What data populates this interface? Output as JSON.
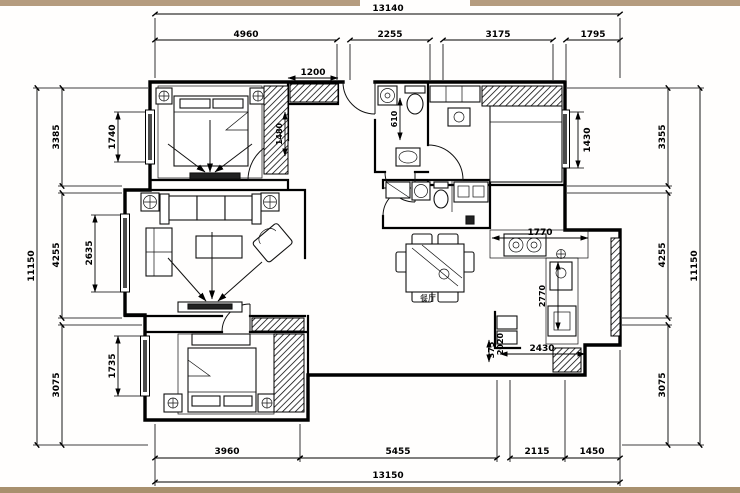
{
  "colors": {
    "edge_strip": "#b59c7f",
    "edge_strip_bottom": "#a8906e",
    "ink": "#000000",
    "paper": "#ffffff"
  },
  "dims": {
    "top": {
      "overall": "13140",
      "segments": [
        "4960",
        "2255",
        "3175",
        "1795"
      ]
    },
    "bottom": {
      "overall": "13150",
      "segments": [
        "3960",
        "5455",
        "2115",
        "1450"
      ]
    },
    "left": {
      "overall": "11150",
      "segments": [
        "3385",
        "4255",
        "3075"
      ],
      "inner": [
        "1740",
        "2635",
        "1735"
      ]
    },
    "right": {
      "overall": "11150",
      "segments": [
        "3355",
        "4255",
        "3075"
      ],
      "inner": [
        "1430"
      ]
    },
    "interior": {
      "entry_closet": "1200",
      "bath_door": "610",
      "wardrobe": "1480",
      "kitchen_counter": "1770",
      "kitchen_side": "2770",
      "passage": "2430",
      "niche_depth": "375",
      "niche_width": "2020"
    }
  },
  "labels": {
    "dining": "餐厅"
  }
}
